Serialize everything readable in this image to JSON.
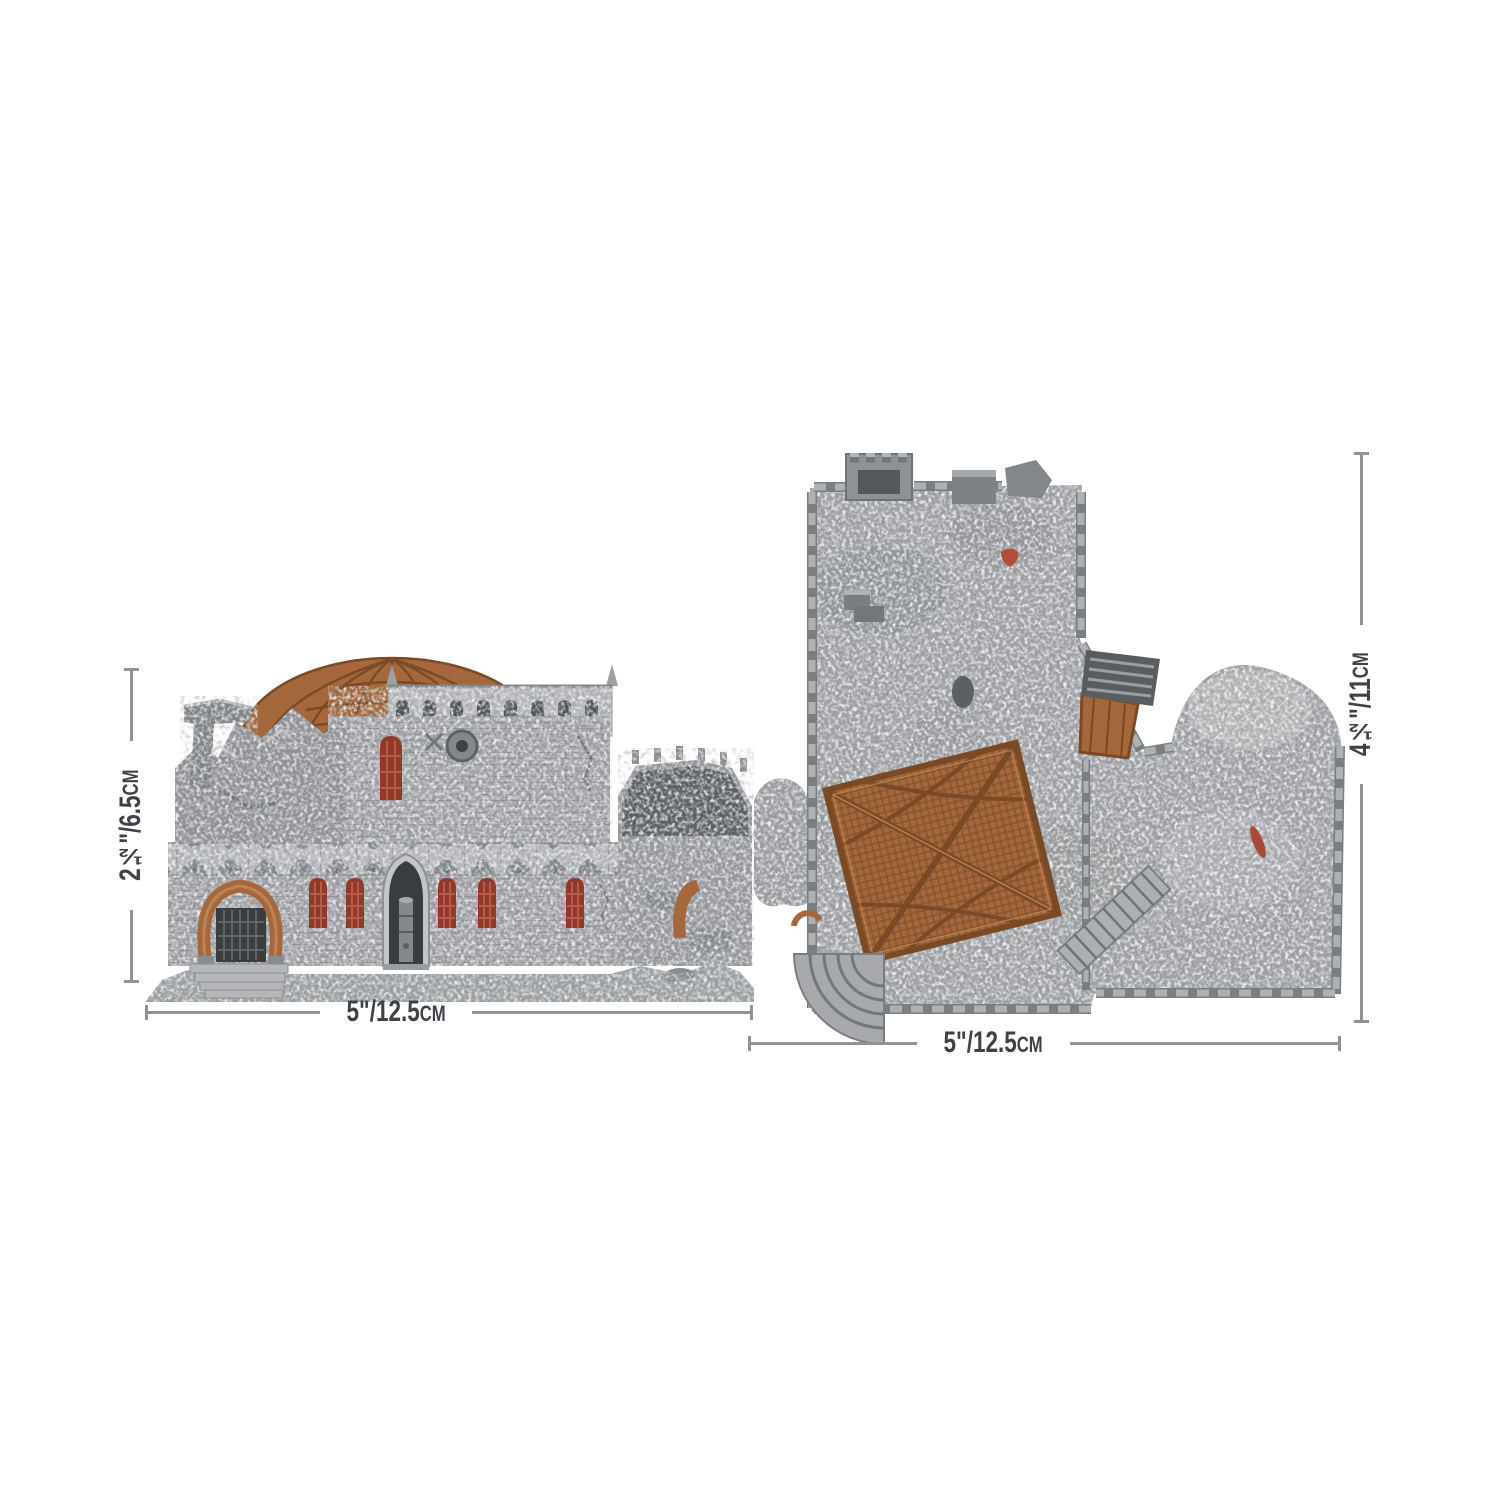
{
  "page": {
    "background": "#ffffff"
  },
  "palette": {
    "line": "#8f9296",
    "label": "#3e4246",
    "stone": "#a4a6a9",
    "stone_light": "#c7c9cb",
    "stone_dark": "#7c7f82",
    "stone_deep": "#5a5d60",
    "copper": "#a5683d",
    "copper_dark": "#7a4a26",
    "copper_light": "#c68f5e",
    "red": "#b04e3a",
    "red_dark": "#8f3a2c",
    "bg": "#ffffff"
  },
  "figures": {
    "side_view_icon": "ruined-domed-building-side-view",
    "top_view_icon": "ruined-building-top-view"
  },
  "dimensions": {
    "left_height": {
      "value": "2½\"/6.5",
      "unit": "cm"
    },
    "left_width": {
      "value": "5\"/12.5",
      "unit": "cm"
    },
    "right_height": {
      "value": "4½\"/11",
      "unit": "cm"
    },
    "right_width": {
      "value": "5\"/12.5",
      "unit": "cm"
    }
  }
}
